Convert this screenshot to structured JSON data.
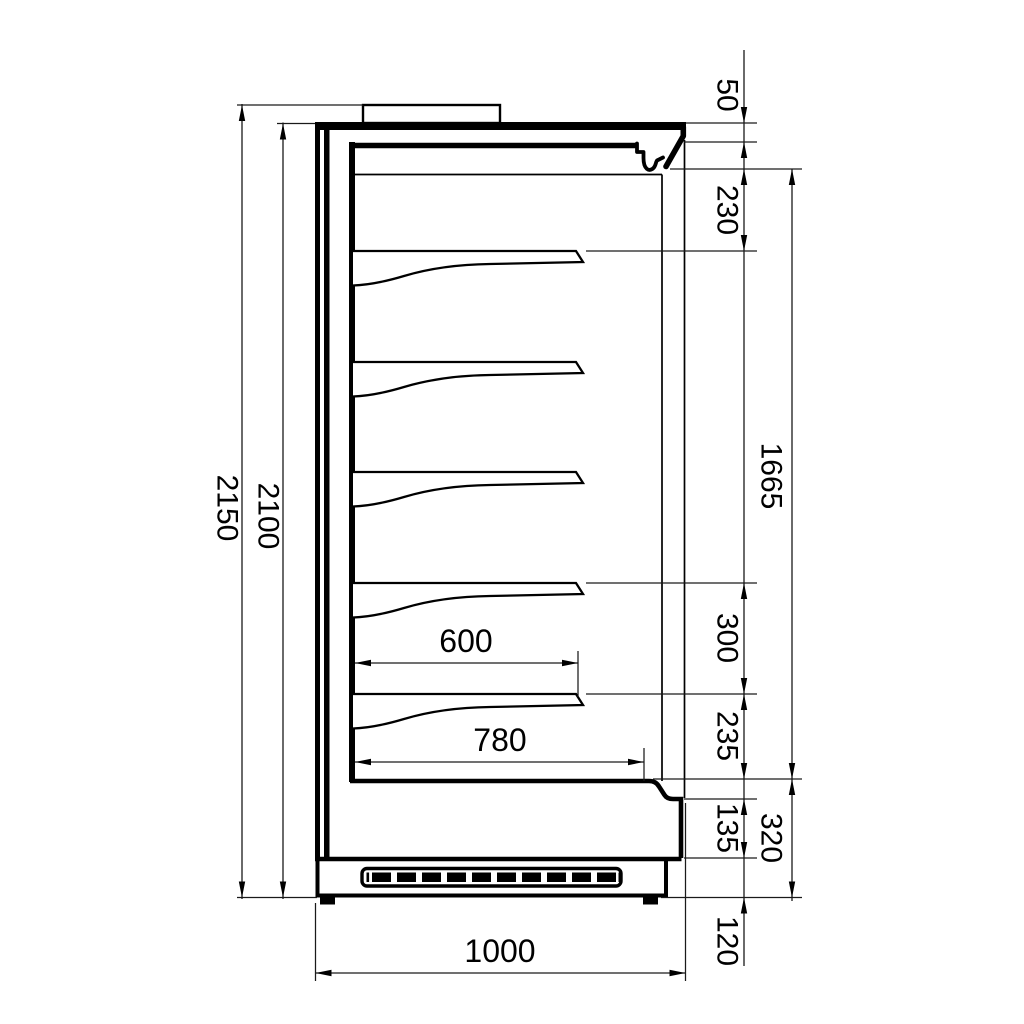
{
  "colors": {
    "line": "#000000",
    "background": "#ffffff"
  },
  "dims": {
    "overall_height": "2150",
    "body_height": "2100",
    "canopy_lip": "50",
    "canopy_zone": "230",
    "display_opening": "1665",
    "bottom_shelf_spacing": "300",
    "deck_clearance": "235",
    "bumper_height": "135",
    "base_section": "320",
    "plinth_height": "120",
    "shelf_depth": "600",
    "deck_depth": "780",
    "overall_depth": "1000"
  }
}
